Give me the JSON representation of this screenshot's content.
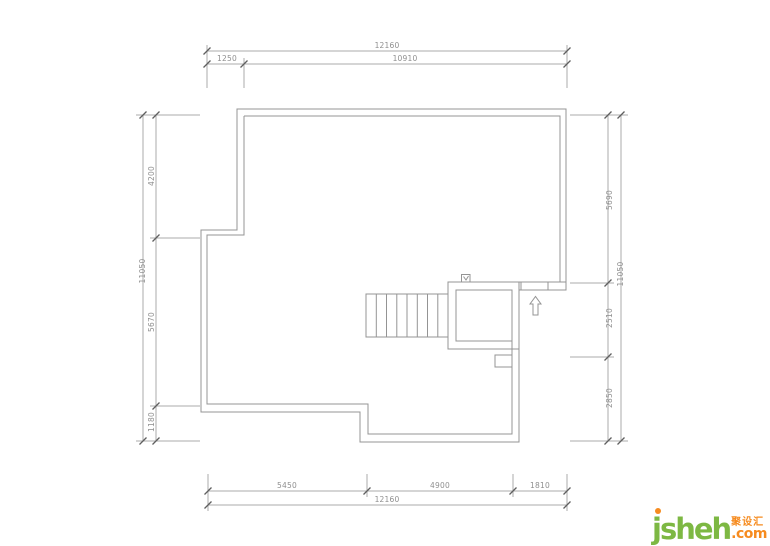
{
  "theme": {
    "line": "#949494",
    "dim": "#ababab",
    "text": "#8f8f8f",
    "tick": "#5f5f5f",
    "logo-green": "#7db843",
    "logo-orange": "#f68b1f"
  },
  "dims": {
    "top": {
      "overall": "12160",
      "seg1": "1250",
      "seg2": "10910"
    },
    "bottom": {
      "overall": "12160",
      "seg1": "5450",
      "seg2": "4900",
      "seg3": "1810"
    },
    "left": {
      "overall": "11050",
      "seg1": "4200",
      "seg2": "5670",
      "seg3": "1180"
    },
    "right": {
      "overall": "11050",
      "seg1": "5690",
      "seg2": "2510",
      "seg3": "2850"
    }
  },
  "logo": {
    "brand": "jsheh",
    "tld": ".com",
    "cjk": "聚设汇"
  }
}
